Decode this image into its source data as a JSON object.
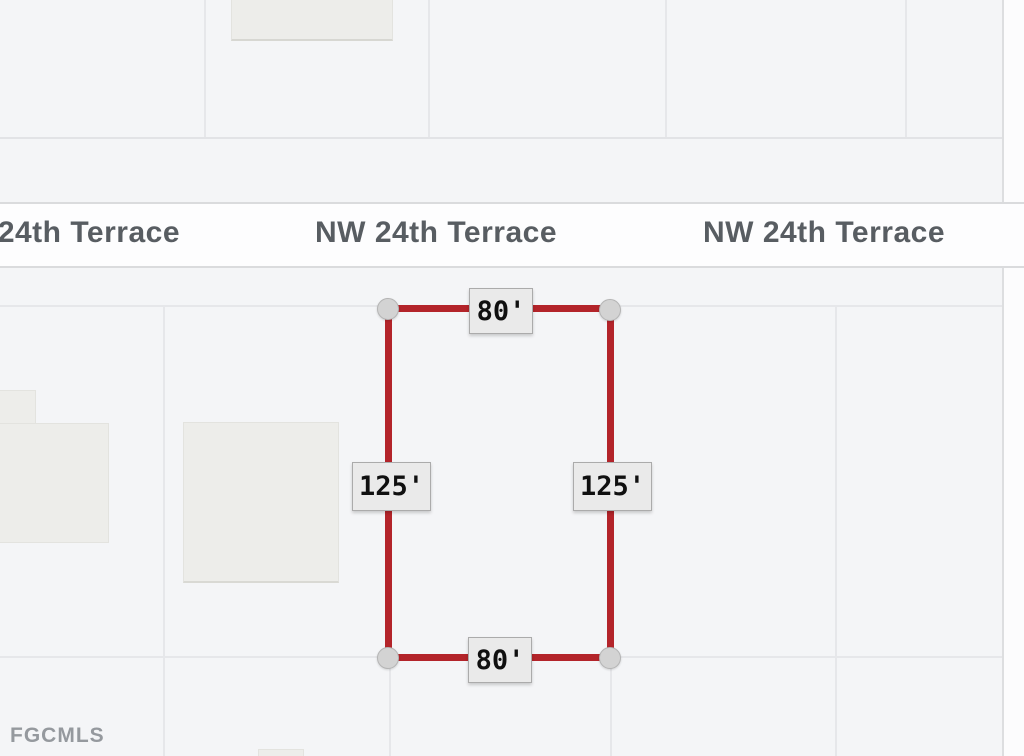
{
  "map": {
    "watermark": "FGCMLS",
    "street_labels": [
      "NW 24th Terrace",
      "NW 24th Terrace",
      "NW 24th Terrace"
    ],
    "parcel_measurements": {
      "top_length": "80'",
      "bottom_length": "80'",
      "left_length": "125'",
      "right_length": "125'"
    },
    "colors": {
      "parcel_outline": "#b3242a",
      "corner_handle_fill": "#d3d3d3",
      "dimension_label_background": "#eaeaea",
      "road_fill": "#fdfdfe",
      "map_background": "#f4f5f7",
      "street_label_text": "#585d62"
    }
  }
}
